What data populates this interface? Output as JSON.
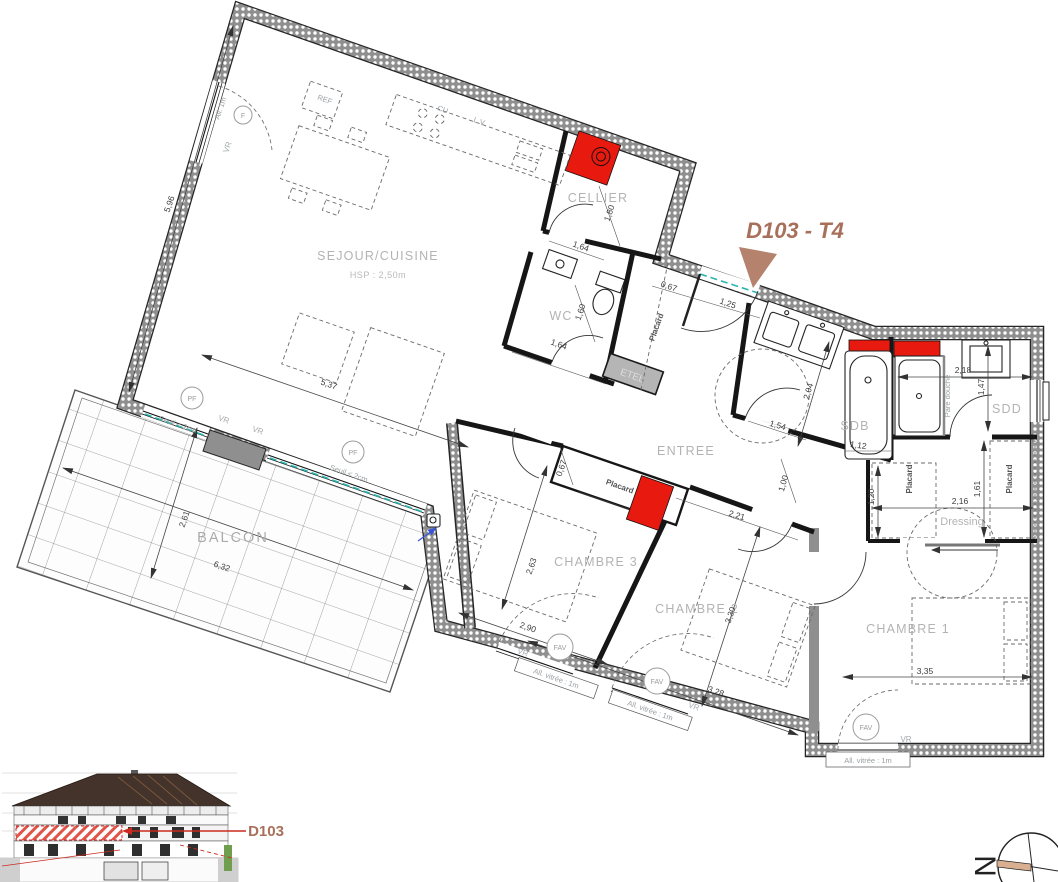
{
  "title": {
    "label": "D103 - T4"
  },
  "rooms": {
    "sejour": "SEJOUR/CUISINE",
    "sejour_height": "HSP : 2,50m",
    "cellier": "CELLIER",
    "wc": "WC",
    "entree": "ENTREE",
    "sdb": "SDB",
    "sdd": "SDD",
    "dressing": "Dressing",
    "chambre1": "CHAMBRE 1",
    "chambre2": "CHAMBRE 2",
    "chambre3": "CHAMBRE 3",
    "balcon": "BALCON",
    "etel": "ETEL"
  },
  "fixtures": {
    "placard": "Placard",
    "pare_douche": "Pare douche",
    "cuisine_hob": "CU",
    "lave_vaisselle": "L.V.",
    "refrigerateur": "REF"
  },
  "openings": {
    "volet_roulant": "VR",
    "fenetre": "F",
    "porte_fenetre": "PF",
    "fenetre_a_vantaux": "FAV",
    "seuil": "Seuil < 2cm",
    "allege_1m": "All. 1m",
    "allege_vitree": "All. vitrée : 1m"
  },
  "dimensions": {
    "sejour_length": "5,96",
    "sejour_width": "5,37",
    "cellier_depth": "1,80",
    "cellier_width": "1,64",
    "wc_depth": "1,60",
    "wc_width": "1,64",
    "entry_offset": "0,67",
    "entry_door": "1,25",
    "sdb_depth": "2,04",
    "sdb_width": "1,54",
    "bathtub_length": "1,12",
    "hall_width": "1,00",
    "sdd_width": "2,18",
    "sdd_depth": "1,47",
    "placard_right_depth": "1,61",
    "placard_left_depth": "1,20",
    "dressing_width": "2,16",
    "chambre1_width": "3,35",
    "chambre2_depth": "3,30",
    "chambre2_width": "3,28",
    "hall_diag": "2,21",
    "chambre3_depth": "2,63",
    "chambre3_width": "2,90",
    "chambre3_placard_depth": "0,67",
    "balcon_depth": "2,61",
    "balcon_width": "6,32"
  },
  "elevation": {
    "unit_label": "D103"
  },
  "compass": {
    "north": "N"
  },
  "colors": {
    "wall_gray": "#8f8f8f",
    "accent_red": "#e8190f",
    "title_brown": "#a8705a",
    "threshold_teal": "#2ab5ac",
    "balcony_arrow_blue": "#3b55d6"
  }
}
